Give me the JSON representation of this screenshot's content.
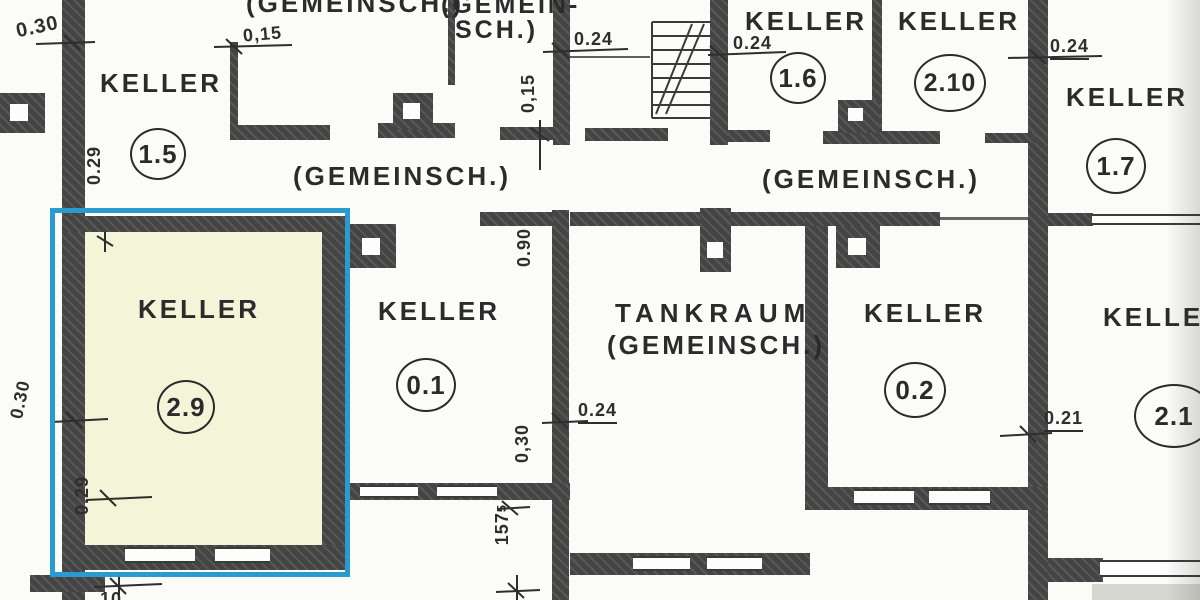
{
  "rooms": {
    "keller_15": {
      "label": "KELLER",
      "number": "1.5"
    },
    "gemeinsch_top": {
      "label": "(GEMEINSCH.)"
    },
    "gemein_top": {
      "line1": "(GEMEIN-",
      "line2": "SCH.)"
    },
    "keller_16": {
      "label": "KELLER",
      "number": "1.6"
    },
    "keller_210": {
      "label": "KELLER",
      "number": "2.10"
    },
    "keller_17": {
      "label": "KELLER",
      "number": "1.7"
    },
    "corridor_left": {
      "label": "(GEMEINSCH.)"
    },
    "corridor_right": {
      "label": "(GEMEINSCH.)"
    },
    "keller_29": {
      "label": "KELLER",
      "number": "2.9",
      "highlighted": true
    },
    "keller_01": {
      "label": "KELLER",
      "number": "0.1"
    },
    "tankraum": {
      "line1": "TANKRAUM",
      "line2": "(GEMEINSCH.)"
    },
    "keller_02": {
      "label": "KELLER",
      "number": "0.2"
    },
    "keller_2x": {
      "label": "KELLER",
      "number": "2.1"
    }
  },
  "dims": {
    "d030_topleft": "0.30",
    "d015_top": "0,15",
    "d024_stair_left": "0.24",
    "d024_stair_right": "0.24",
    "d024_topright": "0.24",
    "d015_vert": "0,15",
    "d090_vert": "0.90",
    "d029_upper": "0.29",
    "d030_leftedge": "0.30",
    "d029_lower": "0.29",
    "d024_mid": "0.24",
    "d030_mid": "0,30",
    "d1575_main": "157",
    "d1575_sup": "5",
    "d021_right": "0.21",
    "d10_bottom": "10"
  },
  "highlight": {
    "room": "2.9",
    "border_color": "#2a9bd0",
    "fill_color": "#f3f4d8"
  },
  "colors": {
    "wall": "#4a4a4a",
    "ink": "#2b2b2b",
    "paper": "#fbfbf8"
  }
}
